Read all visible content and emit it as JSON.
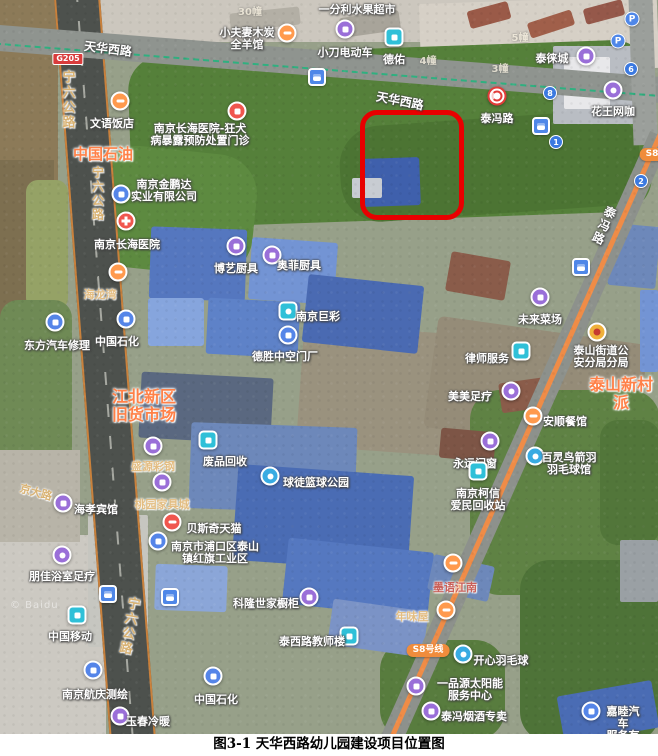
{
  "figure": {
    "caption": "图3-1 天华西路幼儿园建设项目位置图"
  },
  "colors": {
    "highlight_box": "#e80000",
    "metro_line": "#ef8c47",
    "area_label_orange": "#ff8148",
    "road_label_tan": "#d9b272",
    "pin_purple": "#9a6fd8",
    "pin_teal": "#2fc0d8",
    "pin_blue": "#5585e8",
    "pin_orange": "#ff9a4e",
    "pin_red": "#f0564e"
  },
  "map": {
    "watermark": "© Baidu",
    "road_labels": [
      {
        "t": "宁六公路",
        "x": 67,
        "y": 70,
        "v": true,
        "s": "tan",
        "fs": 13
      },
      {
        "t": "宁六公路",
        "x": 98,
        "y": 166,
        "v": true,
        "s": "tan",
        "fs": 12
      },
      {
        "t": "宁六公路",
        "x": 128,
        "y": 596,
        "v": true,
        "s": "tan",
        "fs": 13,
        "rot": 10
      },
      {
        "t": "天华西路",
        "x": 108,
        "y": 40,
        "rot": 7
      },
      {
        "t": "天华西路",
        "x": 400,
        "y": 92,
        "rot": 11
      },
      {
        "t": "泰冯路",
        "x": 604,
        "y": 205,
        "v": true,
        "rot": 24
      },
      {
        "t": "京大路",
        "x": 36,
        "y": 484,
        "rot": 15,
        "s": "tan",
        "fs": 11
      }
    ],
    "area_labels": [
      {
        "t": "中国石油",
        "x": 103,
        "y": 146,
        "fs": 15
      },
      {
        "t": "江北新区\n旧货市场",
        "x": 144,
        "y": 388,
        "fs": 16
      },
      {
        "t": "泰山新村派",
        "x": 584,
        "y": 376,
        "fs": 16,
        "anchor": "left"
      }
    ],
    "badges": [
      {
        "t": "G205",
        "x": 68,
        "y": 53,
        "k": "hwy"
      },
      {
        "t": "S8号线",
        "x": 428,
        "y": 644,
        "k": "metro"
      },
      {
        "t": "S8",
        "x": 652,
        "y": 148,
        "k": "metro"
      }
    ],
    "building_numbers": [
      {
        "t": "30幢",
        "x": 250,
        "y": 3
      },
      {
        "t": "4幢",
        "x": 428,
        "y": 52
      },
      {
        "t": "5幢",
        "x": 520,
        "y": 29
      },
      {
        "t": "3幢",
        "x": 500,
        "y": 60
      }
    ],
    "number_pins": [
      {
        "t": "8",
        "x": 550,
        "y": 93
      },
      {
        "t": "6",
        "x": 631,
        "y": 69
      },
      {
        "t": "1",
        "x": 556,
        "y": 142
      },
      {
        "t": "2",
        "x": 641,
        "y": 181
      }
    ],
    "parking_pins": [
      {
        "t": "P",
        "x": 632,
        "y": 19
      },
      {
        "t": "P",
        "x": 618,
        "y": 41
      }
    ],
    "bus_pins": [
      {
        "x": 317,
        "y": 77
      },
      {
        "x": 541,
        "y": 126
      },
      {
        "x": 581,
        "y": 267
      },
      {
        "x": 108,
        "y": 594
      },
      {
        "x": 170,
        "y": 597
      }
    ],
    "pois": [
      {
        "t": "一分利水果超市",
        "x": 357,
        "y": 4
      },
      {
        "t": "小夫妻木炭\n全羊馆",
        "x": 247,
        "y": 27,
        "i": {
          "c": "orange",
          "g": "bar",
          "x": 287,
          "y": 33
        }
      },
      {
        "t": "小刀电动车",
        "x": 345,
        "y": 47,
        "i": {
          "c": "purple",
          "g": "sq",
          "x": 345,
          "y": 29
        }
      },
      {
        "t": "德佑",
        "x": 394,
        "y": 54,
        "i": {
          "c": "teal",
          "g": "sq",
          "x": 394,
          "y": 37
        }
      },
      {
        "t": "泰徕城",
        "x": 552,
        "y": 53,
        "i": {
          "c": "purple",
          "g": "sq",
          "x": 586,
          "y": 56
        }
      },
      {
        "t": "花王网咖",
        "x": 613,
        "y": 106,
        "i": {
          "c": "purple",
          "g": "dot",
          "x": 613,
          "y": 90
        }
      },
      {
        "t": "泰冯路",
        "x": 497,
        "y": 113,
        "i": {
          "c": "metro",
          "g": "none",
          "x": 497,
          "y": 96
        }
      },
      {
        "t": "文语饭店",
        "x": 112,
        "y": 118,
        "i": {
          "c": "orange",
          "g": "bar",
          "x": 120,
          "y": 101
        }
      },
      {
        "t": "南京长海医院-狂犬\n病暴露预防处置门诊",
        "x": 200,
        "y": 123,
        "i": {
          "c": "red",
          "g": "sq",
          "x": 237,
          "y": 111
        }
      },
      {
        "t": "南京金鹏达\n实业有限公司",
        "x": 164,
        "y": 179,
        "i": {
          "c": "blue",
          "g": "sq",
          "x": 121,
          "y": 194
        }
      },
      {
        "t": "南京长海医院",
        "x": 127,
        "y": 239,
        "i": {
          "c": "red",
          "g": "cross",
          "x": 126,
          "y": 221
        }
      },
      {
        "t": "博艺厨具",
        "x": 236,
        "y": 263,
        "i": {
          "c": "purple",
          "g": "sq",
          "x": 236,
          "y": 246
        }
      },
      {
        "t": "奥菲厨具",
        "x": 299,
        "y": 260,
        "i": {
          "c": "purple",
          "g": "sq",
          "x": 272,
          "y": 255
        }
      },
      {
        "t": "海龙湾",
        "x": 100,
        "y": 289,
        "s": "tan",
        "i": {
          "c": "orange",
          "g": "bar",
          "x": 118,
          "y": 272
        }
      },
      {
        "t": "东方汽车修理",
        "x": 57,
        "y": 340,
        "i": {
          "c": "blue",
          "g": "sq",
          "x": 55,
          "y": 322
        }
      },
      {
        "t": "中国石化",
        "x": 117,
        "y": 336,
        "i": {
          "c": "blue",
          "g": "sq",
          "x": 126,
          "y": 319
        }
      },
      {
        "t": "南京巨彩",
        "x": 318,
        "y": 311,
        "i": {
          "c": "teal",
          "g": "dot",
          "x": 288,
          "y": 311
        }
      },
      {
        "t": "德胜中空门厂",
        "x": 285,
        "y": 351,
        "i": {
          "c": "blue",
          "g": "sq",
          "x": 288,
          "y": 335
        }
      },
      {
        "t": "未来菜场",
        "x": 540,
        "y": 314,
        "i": {
          "c": "purple",
          "g": "sq",
          "x": 540,
          "y": 297
        }
      },
      {
        "t": "律师服务",
        "x": 487,
        "y": 353,
        "i": {
          "c": "teal",
          "g": "sq",
          "x": 521,
          "y": 351
        }
      },
      {
        "t": "泰山街道公\n安分局分局",
        "x": 601,
        "y": 345,
        "i": {
          "c": "police",
          "g": "none",
          "x": 597,
          "y": 332
        }
      },
      {
        "t": "美美足疗",
        "x": 470,
        "y": 391,
        "i": {
          "c": "purple",
          "g": "dot",
          "x": 511,
          "y": 391
        }
      },
      {
        "t": "安顺餐馆",
        "x": 565,
        "y": 416,
        "i": {
          "c": "orange",
          "g": "bar",
          "x": 533,
          "y": 416
        }
      },
      {
        "t": "永远门窗",
        "x": 475,
        "y": 458,
        "i": {
          "c": "purple",
          "g": "sq",
          "x": 490,
          "y": 441
        }
      },
      {
        "t": "百灵鸟箭羽\n羽毛球馆",
        "x": 569,
        "y": 452,
        "i": {
          "c": "sport",
          "g": "dot",
          "x": 535,
          "y": 456
        }
      },
      {
        "t": "废品回收",
        "x": 225,
        "y": 456,
        "i": {
          "c": "teal",
          "g": "sq",
          "x": 208,
          "y": 440
        }
      },
      {
        "t": "盛源彩钢",
        "x": 153,
        "y": 461,
        "s": "tan",
        "i": {
          "c": "purple",
          "g": "sq",
          "x": 153,
          "y": 446
        }
      },
      {
        "t": "桃园家具城",
        "x": 162,
        "y": 499,
        "s": "tan",
        "i": {
          "c": "purple",
          "g": "sq",
          "x": 162,
          "y": 482
        }
      },
      {
        "t": "球徒篮球公园",
        "x": 316,
        "y": 477,
        "i": {
          "c": "sport",
          "g": "dot",
          "x": 270,
          "y": 476
        }
      },
      {
        "t": "海孝宾馆",
        "x": 96,
        "y": 504,
        "i": {
          "c": "purple",
          "g": "sq",
          "x": 63,
          "y": 503
        }
      },
      {
        "t": "南京柯信\n爱民回收站",
        "x": 478,
        "y": 488,
        "i": {
          "c": "teal",
          "g": "sq",
          "x": 478,
          "y": 471
        }
      },
      {
        "t": "贝斯奇天猫",
        "x": 214,
        "y": 523,
        "i": {
          "c": "red",
          "g": "bar",
          "x": 172,
          "y": 522
        }
      },
      {
        "t": "南京市浦口区泰山\n镇红旗工业区",
        "x": 215,
        "y": 541,
        "i": {
          "c": "blue",
          "g": "sq",
          "x": 158,
          "y": 541
        }
      },
      {
        "t": "朋佳浴室足疗",
        "x": 62,
        "y": 571,
        "i": {
          "c": "purple",
          "g": "dot",
          "x": 62,
          "y": 555
        }
      },
      {
        "t": "中国移动",
        "x": 70,
        "y": 631,
        "i": {
          "c": "teal",
          "g": "sq",
          "x": 77,
          "y": 615
        }
      },
      {
        "t": "科隆世家橱柜",
        "x": 266,
        "y": 598,
        "i": {
          "c": "purple",
          "g": "sq",
          "x": 309,
          "y": 597
        }
      },
      {
        "t": "泰西路教师楼",
        "x": 312,
        "y": 636,
        "i": {
          "c": "teal",
          "g": "sq",
          "x": 349,
          "y": 636
        }
      },
      {
        "t": "墨语江南",
        "x": 455,
        "y": 582,
        "s": "red",
        "i": {
          "c": "orange",
          "g": "bar",
          "x": 453,
          "y": 563
        }
      },
      {
        "t": "年味屋",
        "x": 412,
        "y": 611,
        "s": "tan",
        "i": {
          "c": "orange",
          "g": "bar",
          "x": 446,
          "y": 610
        }
      },
      {
        "t": "开心羽毛球",
        "x": 501,
        "y": 655,
        "i": {
          "c": "sport",
          "g": "dot",
          "x": 463,
          "y": 654
        }
      },
      {
        "t": "一品源太阳能\n服务中心",
        "x": 470,
        "y": 678,
        "i": {
          "c": "purple",
          "g": "sq",
          "x": 416,
          "y": 686
        }
      },
      {
        "t": "泰冯烟酒专卖",
        "x": 474,
        "y": 711,
        "i": {
          "c": "purple",
          "g": "sq",
          "x": 431,
          "y": 711
        }
      },
      {
        "t": "南京航庆测绘",
        "x": 95,
        "y": 689,
        "i": {
          "c": "blue",
          "g": "sq",
          "x": 93,
          "y": 670
        }
      },
      {
        "t": "中国石化",
        "x": 216,
        "y": 694,
        "i": {
          "c": "blue",
          "g": "sq",
          "x": 213,
          "y": 676
        }
      },
      {
        "t": "玉春冷暖",
        "x": 148,
        "y": 716,
        "i": {
          "c": "purple",
          "g": "sq",
          "x": 120,
          "y": 716
        }
      },
      {
        "t": "嘉睦汽车\n服务有限",
        "x": 623,
        "y": 706,
        "i": {
          "c": "blue",
          "g": "sq",
          "x": 591,
          "y": 711
        }
      }
    ]
  }
}
